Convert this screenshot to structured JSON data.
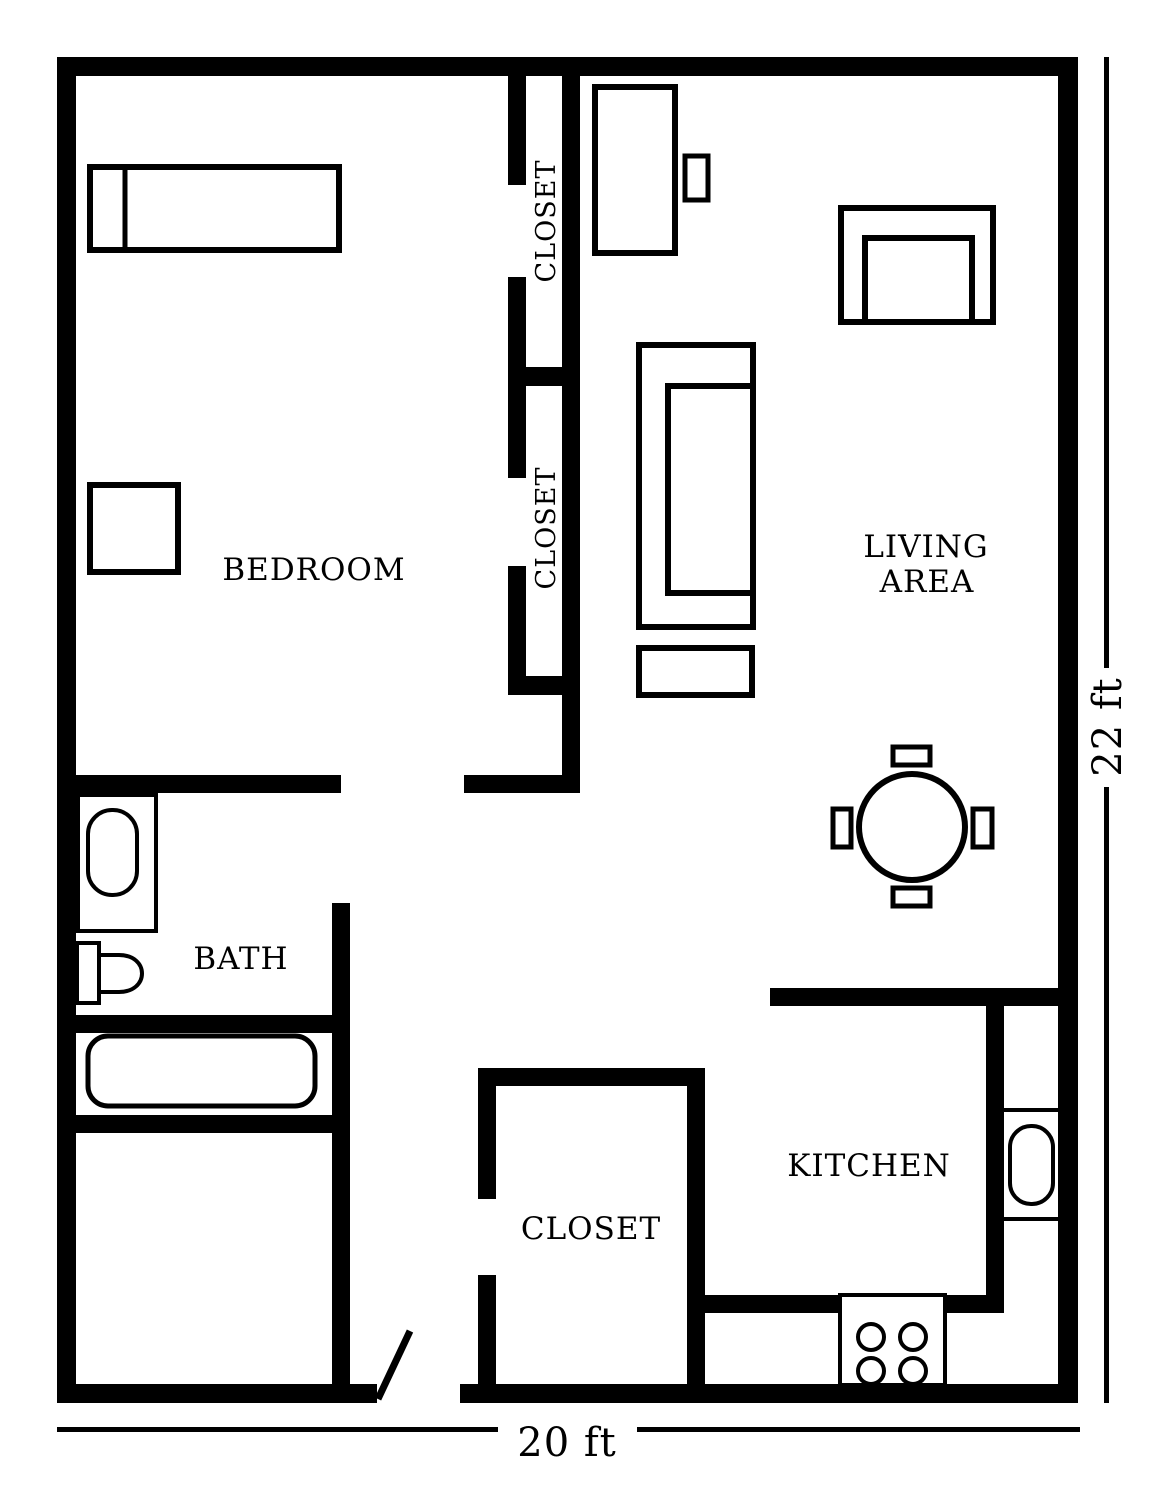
{
  "figure": {
    "type": "apartment-floor-plan",
    "colors": {
      "wall": "#000000",
      "background": "#ffffff",
      "text": "#000000"
    }
  },
  "labels": {
    "bedroom": "BEDROOM",
    "living_line1": "LIVING",
    "living_line2": "AREA",
    "bath": "BATH",
    "kitchen": "KITCHEN",
    "closet_upper": "CLOSET",
    "closet_lower": "CLOSET",
    "closet_bottom": "CLOSET"
  },
  "dimensions": {
    "width": "20 ft",
    "height": "22 ft"
  },
  "furniture": [
    "bed",
    "nightstand",
    "tv-stand",
    "media-console",
    "armchair",
    "sofa",
    "coffee-table",
    "dining-table",
    "dining-chairs",
    "bathroom-sink-cabinet",
    "bathroom-sink",
    "toilet",
    "bathtub",
    "kitchen-sink",
    "stove-burners"
  ]
}
